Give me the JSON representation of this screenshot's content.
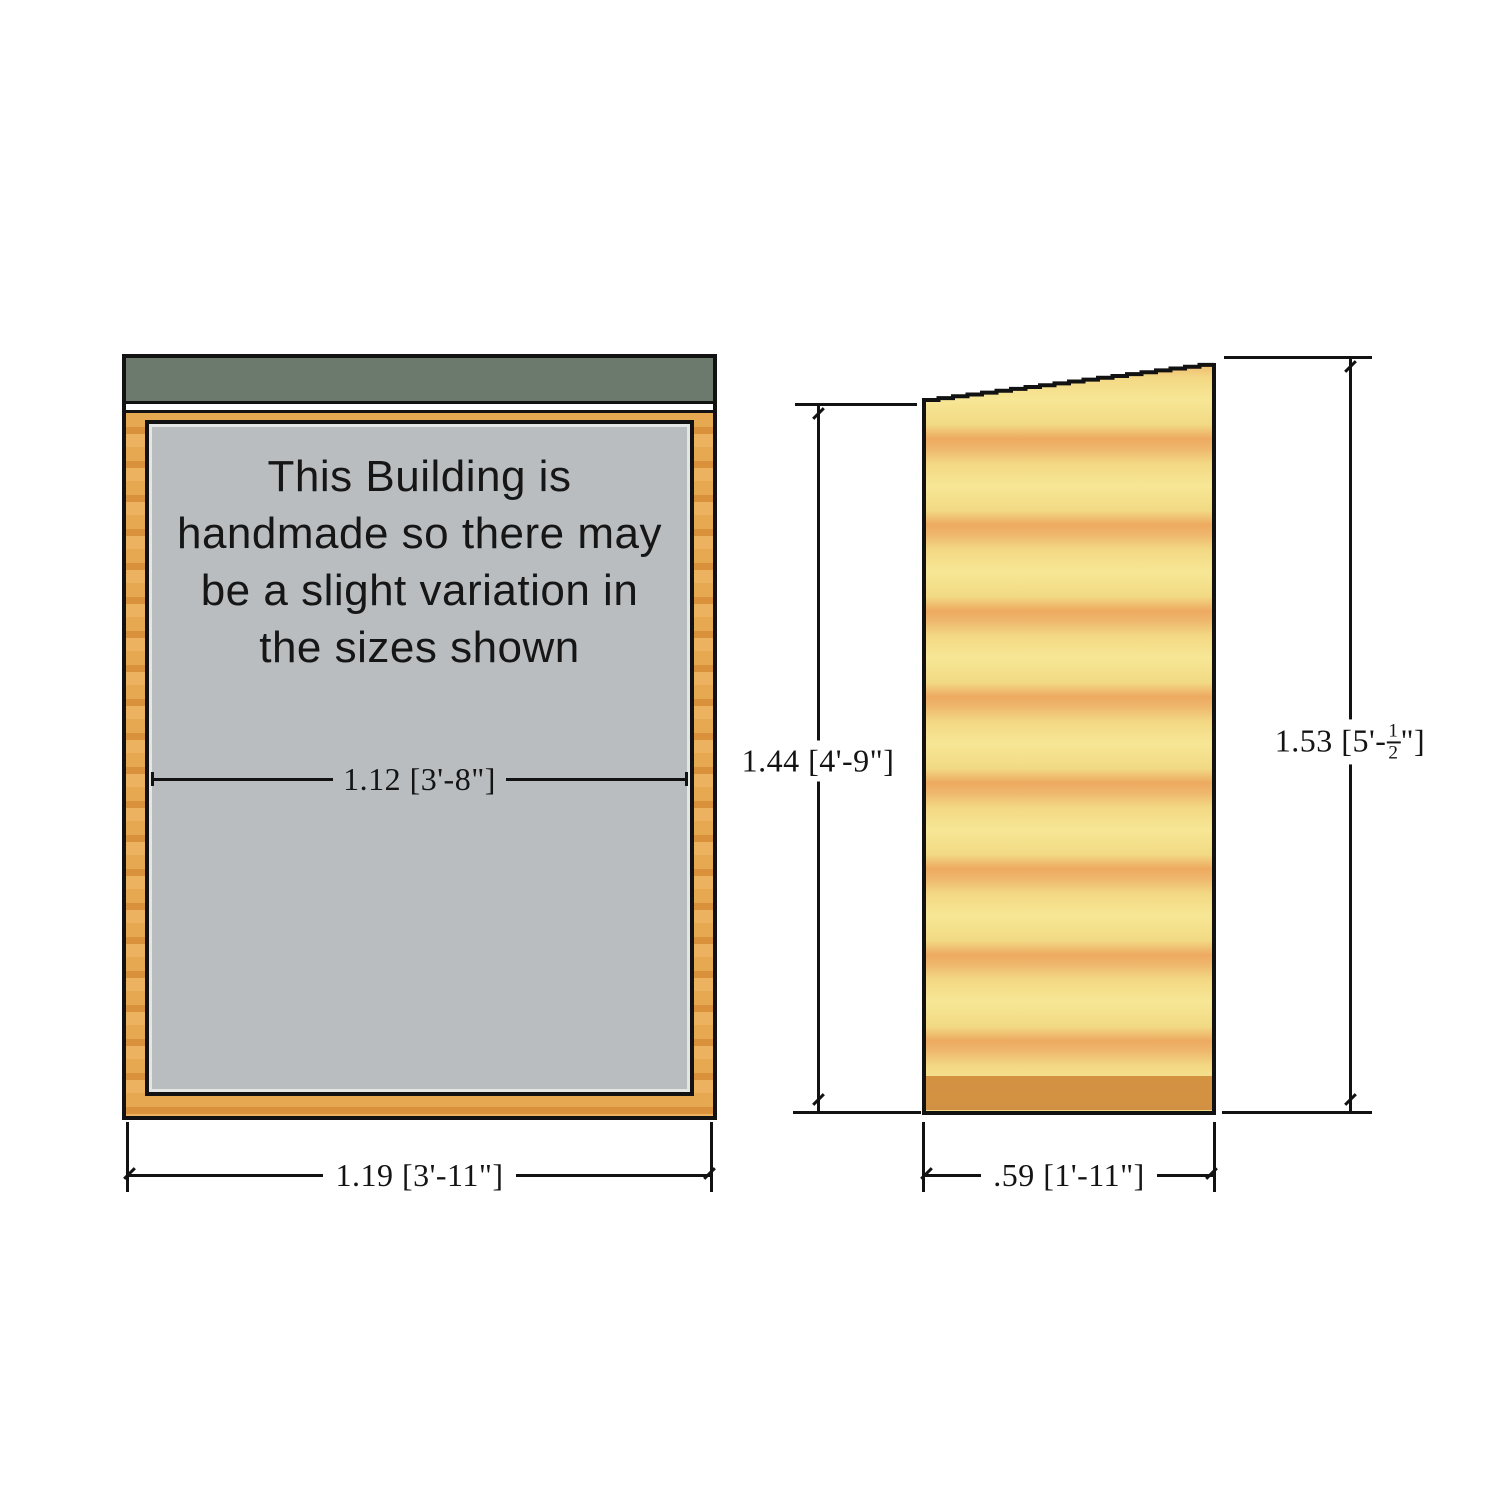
{
  "front_view": {
    "notice_lines": [
      "This Building is",
      "handmade so there may",
      "be a slight variation in",
      "the sizes shown"
    ],
    "interior_width_label": "1.12 [3'-8\"]",
    "overall_width_label": "1.19 [3'-11\"]"
  },
  "side_view": {
    "height_front_label": "1.44 [4'-9\"]",
    "height_back": {
      "prefix": "1.53 [5'-",
      "frac_numerator": "1",
      "frac_denominator": "2",
      "suffix": "\"]"
    },
    "depth_label": ".59 [1'-11\"]"
  },
  "colors": {
    "roof_green": "#6b7a6d",
    "frame_wood": "#e2a14e",
    "panel_gray": "#b9bdc0",
    "cladding_yellow": "#f6e392",
    "cladding_band_orange": "#eca95e",
    "floor_band_orange": "#cf8a3c",
    "outline_black": "#121212"
  }
}
